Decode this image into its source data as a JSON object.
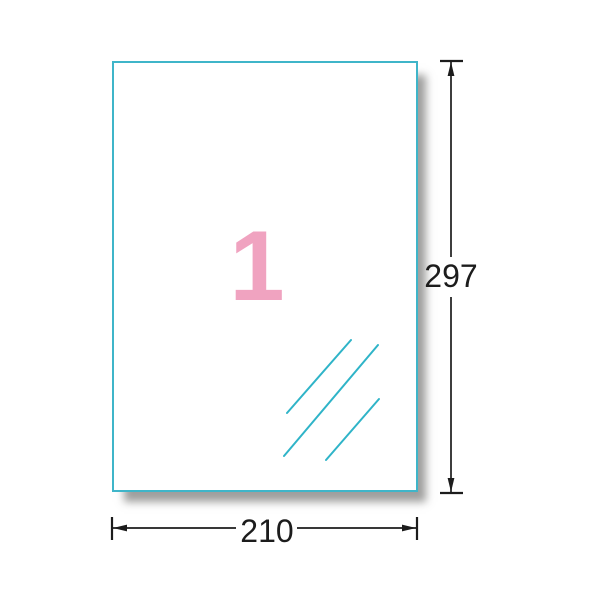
{
  "diagram": {
    "label_count": "1",
    "dimensions": {
      "height_label": "297",
      "width_label": "210"
    },
    "colors": {
      "sheet_border": "#3fb5c9",
      "hatch_line": "#2fb4c8",
      "label_number_pink": "#f0a3c0",
      "dimension_ink": "#1c1c1c"
    }
  }
}
